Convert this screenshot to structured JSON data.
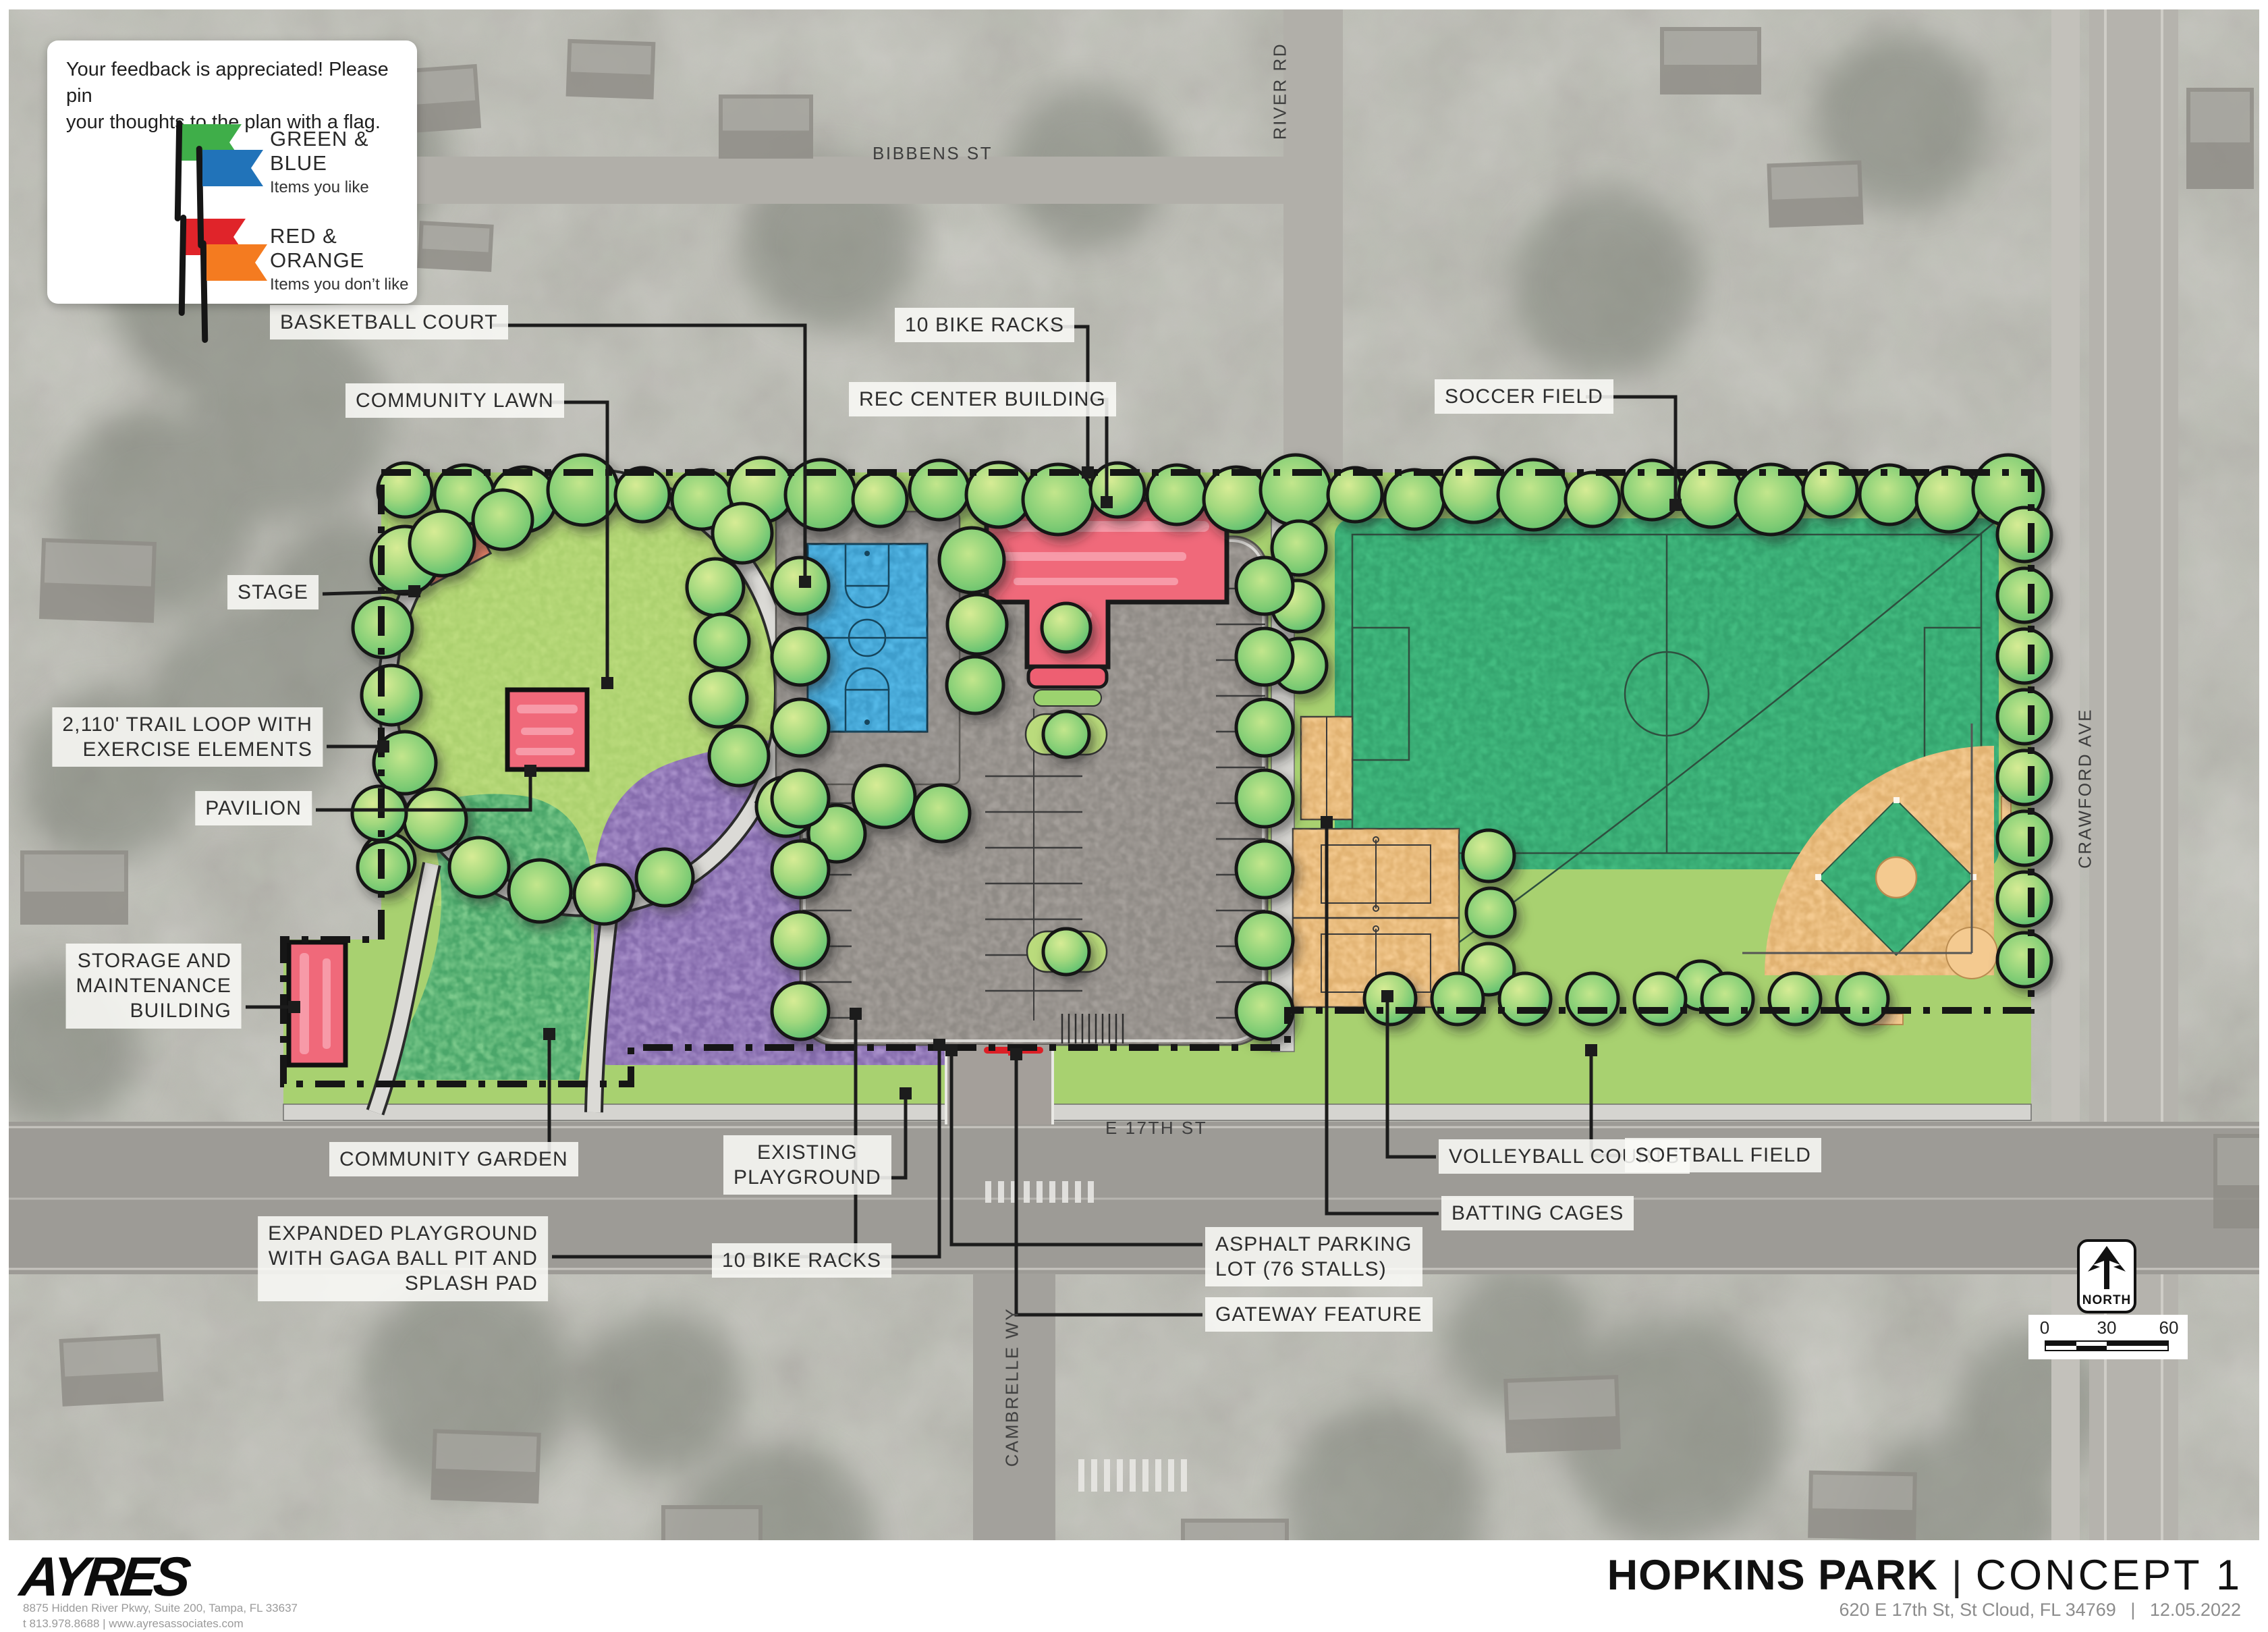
{
  "legend": {
    "intro": [
      "Your feedback is appreciated! Please pin",
      "your thoughts to the plan with a flag."
    ],
    "items": [
      {
        "name": "GREEN & BLUE",
        "desc": "Items you like"
      },
      {
        "name": "RED & ORANGE",
        "desc": "Items you don’t like"
      }
    ]
  },
  "callouts": [
    {
      "id": "basketball-court",
      "lines": [
        "BASKETBALL COURT"
      ]
    },
    {
      "id": "community-lawn",
      "lines": [
        "COMMUNITY LAWN"
      ]
    },
    {
      "id": "stage",
      "lines": [
        "STAGE"
      ]
    },
    {
      "id": "trail-loop",
      "lines": [
        "2,110' TRAIL LOOP WITH",
        "EXERCISE ELEMENTS"
      ]
    },
    {
      "id": "pavilion",
      "lines": [
        "PAVILION"
      ]
    },
    {
      "id": "storage-maintenance",
      "lines": [
        "STORAGE AND",
        "MAINTENANCE",
        "BUILDING"
      ]
    },
    {
      "id": "community-garden",
      "lines": [
        "COMMUNITY GARDEN"
      ]
    },
    {
      "id": "expanded-playground",
      "lines": [
        "EXPANDED PLAYGROUND",
        "WITH GAGA BALL PIT AND",
        "SPLASH PAD"
      ]
    },
    {
      "id": "bike-racks-south",
      "lines": [
        "10 BIKE RACKS"
      ]
    },
    {
      "id": "existing-playground",
      "lines": [
        "EXISTING",
        "PLAYGROUND"
      ]
    },
    {
      "id": "bike-racks-north",
      "lines": [
        "10 BIKE RACKS"
      ]
    },
    {
      "id": "rec-center",
      "lines": [
        "REC CENTER BUILDING"
      ]
    },
    {
      "id": "soccer-field",
      "lines": [
        "SOCCER FIELD"
      ]
    },
    {
      "id": "volleyball-courts",
      "lines": [
        "VOLLEYBALL COURTS"
      ]
    },
    {
      "id": "batting-cages",
      "lines": [
        "BATTING CAGES"
      ]
    },
    {
      "id": "softball-field",
      "lines": [
        "SOFTBALL FIELD"
      ]
    },
    {
      "id": "asphalt-parking",
      "lines": [
        "ASPHALT PARKING",
        "LOT (76 STALLS)"
      ]
    },
    {
      "id": "gateway-feature",
      "lines": [
        "GATEWAY FEATURE"
      ]
    }
  ],
  "streets": [
    {
      "id": "bibbens",
      "name": "BIBBENS ST"
    },
    {
      "id": "river",
      "name": "RIVER RD"
    },
    {
      "id": "crawford",
      "name": "CRAWFORD AVE"
    },
    {
      "id": "e17th",
      "name": "E 17TH ST"
    },
    {
      "id": "cambrelle",
      "name": "CAMBRELLE WY"
    }
  ],
  "north_arrow": {
    "label": "NORTH"
  },
  "scale_bar": {
    "ticks": [
      "0",
      "30",
      "60"
    ]
  },
  "title_block": {
    "firm": "AYRES",
    "firm_address": "8875 Hidden River Pkwy, Suite 200, Tampa, FL 33637",
    "firm_contact": "t 813.978.8688  |  www.ayresassociates.com",
    "title_primary": "HOPKINS PARK",
    "title_divider": "|",
    "title_secondary": "CONCEPT 1",
    "project_address": "620 E 17th St, St Cloud, FL 34769",
    "date": "12.05.2022"
  },
  "colors": {
    "flag_green": "#3fae49",
    "flag_blue": "#2173b9",
    "flag_red": "#e0242a",
    "flag_orange": "#f47b20",
    "building_red": "#f0697a",
    "stage_orange": "#f5876c",
    "court_blue": "#54b8e7",
    "soccer_green": "#43bb80",
    "lawn_green": "#badb7c",
    "garden_green": "#7bc98b",
    "playground_purple": "#a78fc9",
    "sand_orange": "#f4ca90",
    "parking_gray": "#a49f9a",
    "gateway_red": "#dc1f26"
  }
}
